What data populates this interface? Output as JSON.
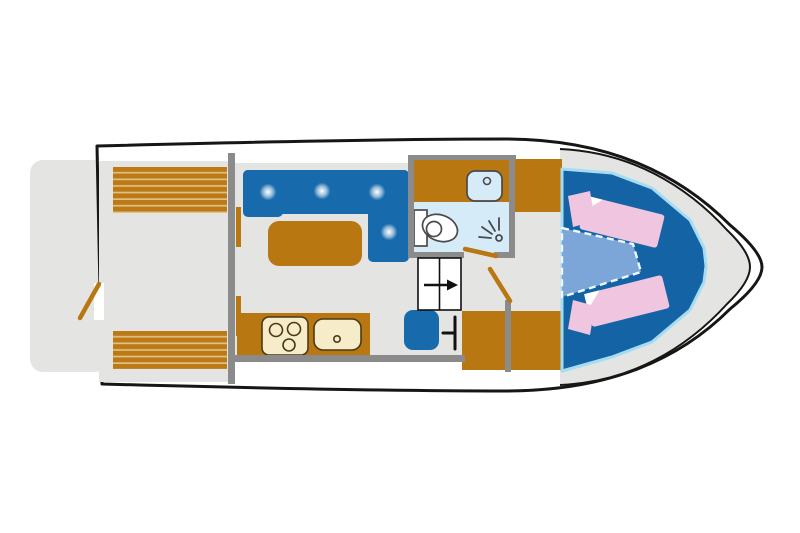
{
  "diagram": {
    "type": "boat-deck-floor-plan",
    "subject": "Top-down floor plan of a motor yacht",
    "areas": {
      "swim_platform": "Swim platform",
      "aft_deck": "Aft deck with two slatted bench seats",
      "saloon": "Saloon with L-shaped sofa, four seat cushions and a table",
      "galley": "Galley with three-burner stove and sink",
      "bathroom": "Bathroom with washbasin, toilet and shower",
      "companionway": "Steps with direction arrow",
      "wardrobe": "Wardrobe cabinets",
      "forward_cabin": "Bow cabin with two berths, two pillows and dashed infill cushion"
    },
    "counts": {
      "stove_burners": 3,
      "sofa_cushions": 4,
      "bench_seats": 2,
      "berths": 2,
      "pillows": 2
    }
  },
  "palette": {
    "white": "#ffffff",
    "floor": "#e4e4e2",
    "wall": "#8b8b8b",
    "hull_outline": "#161616",
    "brown": "#b97712",
    "slat_brown": "#bc7a16",
    "slat_gap": "#e0c084",
    "blue": "#176bac",
    "platform_blue": "#1463a4",
    "edge_light_blue": "#a6dcf2",
    "bath_blue": "#d5ecf8",
    "infill_blue": "#7ca6d8",
    "infill_dash": "#ecf8ff",
    "pink": "#f0c5e0",
    "cream": "#f7ecca",
    "dark_outline": "#4a3a14",
    "fixture_outline": "#4a4a4a",
    "black": "#111111"
  }
}
